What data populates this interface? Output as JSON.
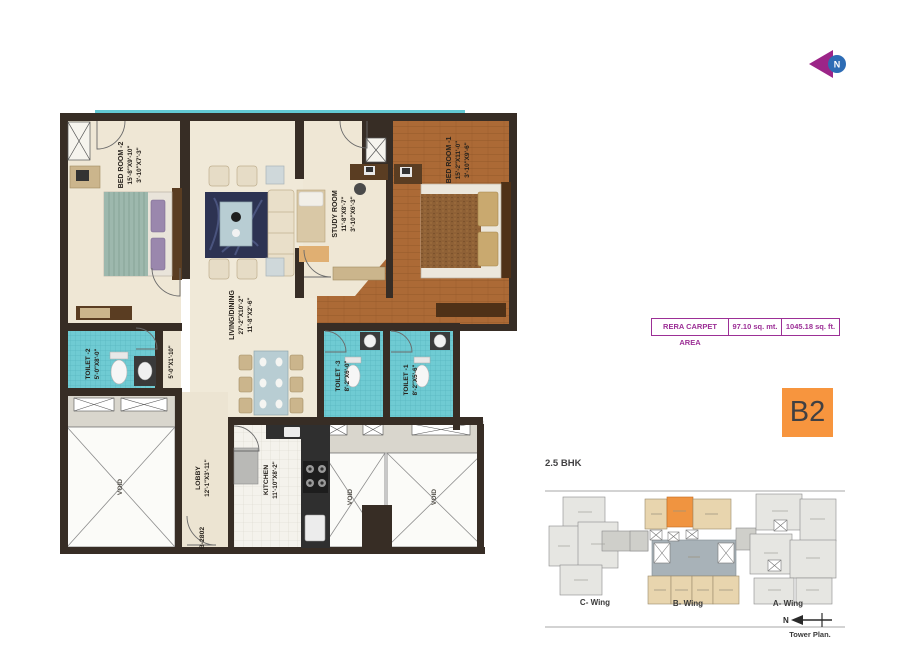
{
  "north_icon": {
    "letter": "N"
  },
  "rera_table": {
    "label": "RERA CARPET AREA",
    "area_sqmt": "97.10 sq. mt.",
    "area_sqft": "1045.18 sq. ft."
  },
  "unit": {
    "badge": "B2",
    "type": "2.5 BHK"
  },
  "floor_plan": {
    "bedroom2": {
      "name": "BED ROOM -2",
      "dim": "15'-8\"X9'-10\"",
      "deck_dim": "3'-10\"X7'-3\""
    },
    "bedroom1": {
      "name": "BED ROOM -1",
      "dim": "15'-2\"X11'-0\"",
      "deck_dim": "3'-10\"X9'-6\""
    },
    "study": {
      "name": "STUDY ROOM",
      "dim": "11'-8\"X8'-7\"",
      "deck_dim": "3'-10\"X6'-3\""
    },
    "living": {
      "name": "LIVING/DINING",
      "dim": "27'-2\"X10'-2\"",
      "deck_dim": "11'-8\"X2'-6\""
    },
    "toilet2": {
      "name": "TOILET -2",
      "dim": "5'-0\"X8'-0\""
    },
    "toilet3": {
      "name": "TOILET -3",
      "dim": "8'-2\"X6'-0\""
    },
    "toilet1": {
      "name": "TOILET -1",
      "dim": "8'-2\"X5'-6\""
    },
    "kitchen": {
      "name": "KITCHEN",
      "dim": "11'-10\"X8'-2\""
    },
    "lobby": {
      "name": "LOBBY",
      "dim": "12'-1\"X3'-11\""
    },
    "passage_dim": "5'-0\"X1'-10\"",
    "unit_number": "B-2802",
    "void": "VOID"
  },
  "tower_plan": {
    "wing_c": "C- Wing",
    "wing_b": "B- Wing",
    "wing_a": "A- Wing",
    "north": "N",
    "caption": "Tower Plan."
  },
  "colors": {
    "badge_orange": "#f7953e",
    "rera_purple": "#9c2f96",
    "wall_dark": "#372d25",
    "tile_teal": "#6fcbd3",
    "wood": "#ac6a36",
    "highlight_unit": "#f09440"
  }
}
